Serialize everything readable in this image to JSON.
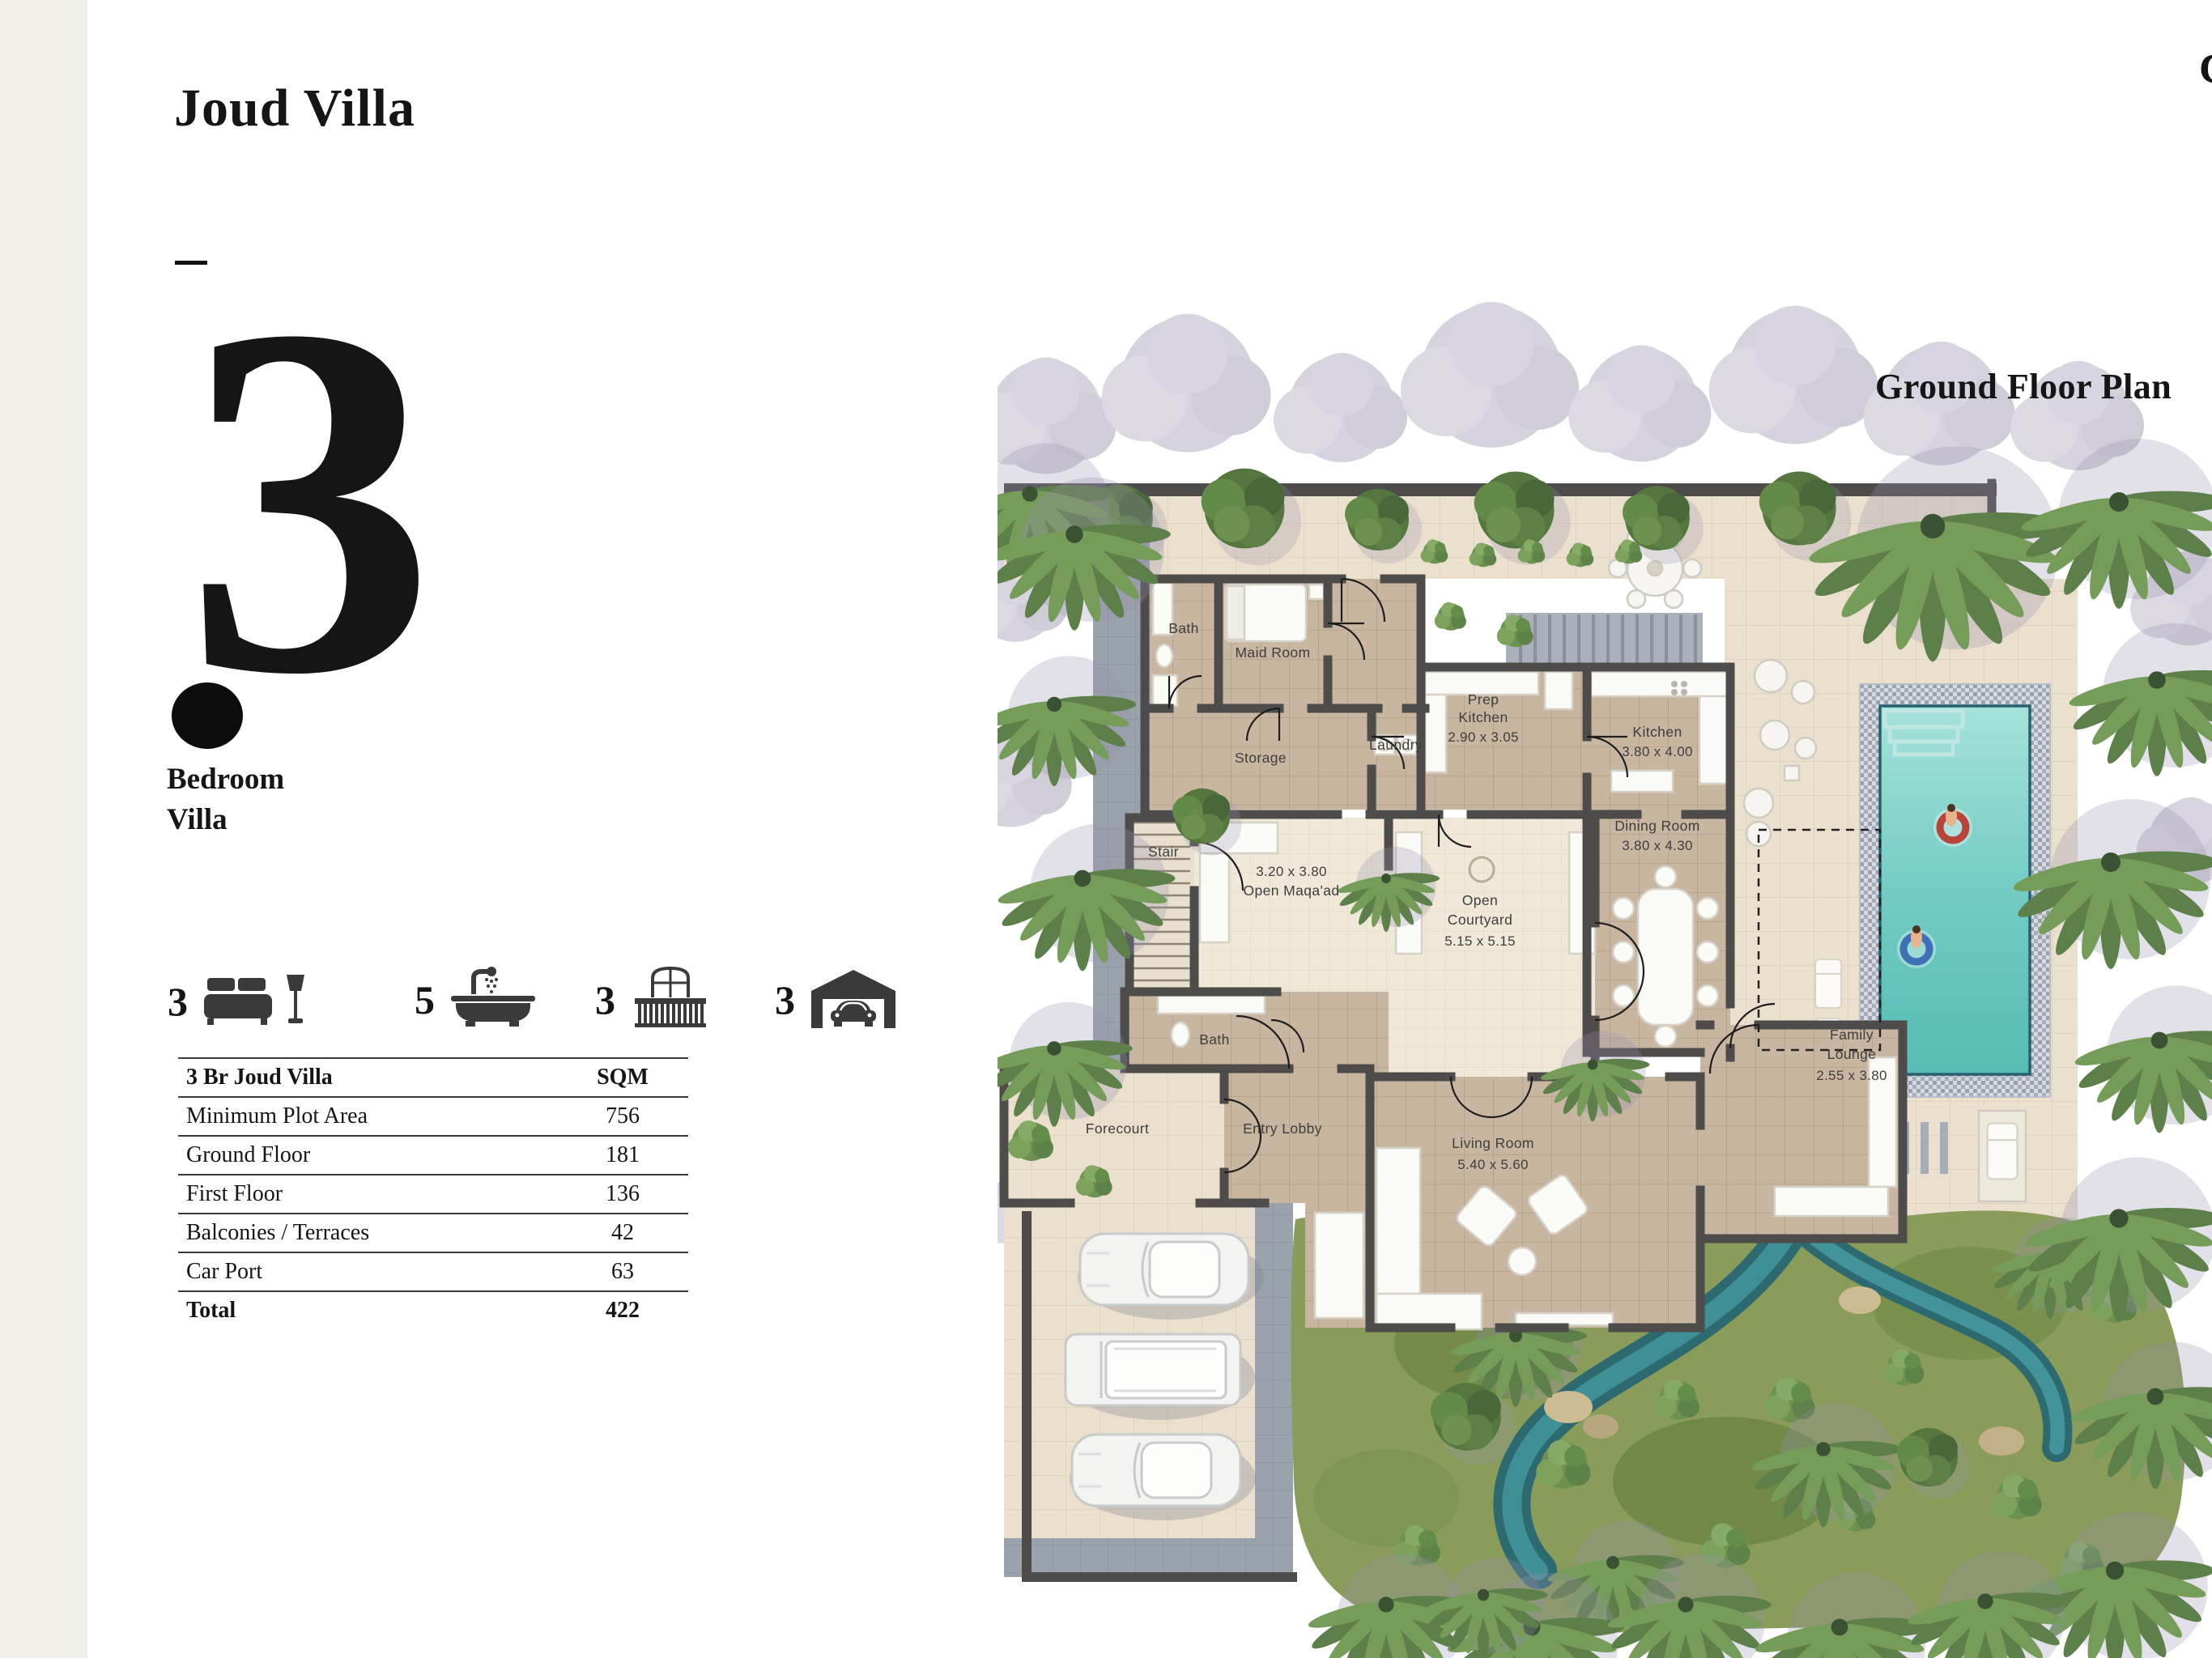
{
  "page": {
    "title": "Joud Villa",
    "corner_letter": "C",
    "plan_title": "Ground Floor Plan",
    "bedroom_count": "3",
    "bedroom_line1": "Bedroom",
    "bedroom_line2": "Villa"
  },
  "features": [
    {
      "name": "bedrooms",
      "count": "3"
    },
    {
      "name": "bathrooms",
      "count": "5"
    },
    {
      "name": "balconies",
      "count": "3"
    },
    {
      "name": "car_ports",
      "count": "3"
    }
  ],
  "area_table": {
    "header": {
      "name": "3 Br Joud Villa",
      "unit": "SQM"
    },
    "rows": [
      {
        "label": "Minimum Plot Area",
        "value": "756"
      },
      {
        "label": "Ground Floor",
        "value": "181"
      },
      {
        "label": "First Floor",
        "value": "136"
      },
      {
        "label": "Balconies / Terraces",
        "value": "42"
      },
      {
        "label": "Car Port",
        "value": "63"
      }
    ],
    "total": {
      "label": "Total",
      "value": "422"
    }
  },
  "floor_plan": {
    "labels": {
      "bath1": "Bath",
      "maid_room": "Maid Room",
      "storage": "Storage",
      "laundry": "Laundry",
      "prep_kitchen_l1": "Prep",
      "prep_kitchen_l2": "Kitchen",
      "prep_kitchen_dims": "2.90 x 3.05",
      "kitchen": "Kitchen",
      "kitchen_dims": "3.80 x 4.00",
      "stair": "Stair",
      "open_maqaad_dims": "3.20 x 3.80",
      "open_maqaad": "Open Maqa'ad",
      "courtyard_l1": "Open",
      "courtyard_l2": "Courtyard",
      "courtyard_dims": "5.15 x 5.15",
      "dining_room": "Dining Room",
      "dining_room_dims": "3.80 x 4.30",
      "family_lounge_l1": "Family",
      "family_lounge_l2": "Lounge",
      "family_lounge_dims": "2.55 x 3.80",
      "living_room": "Living Room",
      "living_room_dims": "5.40 x 5.60",
      "bath2": "Bath",
      "forecourt": "Forecourt",
      "entry_lobby": "Entry Lobby"
    },
    "colors": {
      "wall": "#4e4c4b",
      "indoor_floor": "#c8b6a1",
      "outdoor_deck": "#eae0cd",
      "pool_water": "#63c4bc",
      "greenery": "#5d7f49"
    }
  }
}
